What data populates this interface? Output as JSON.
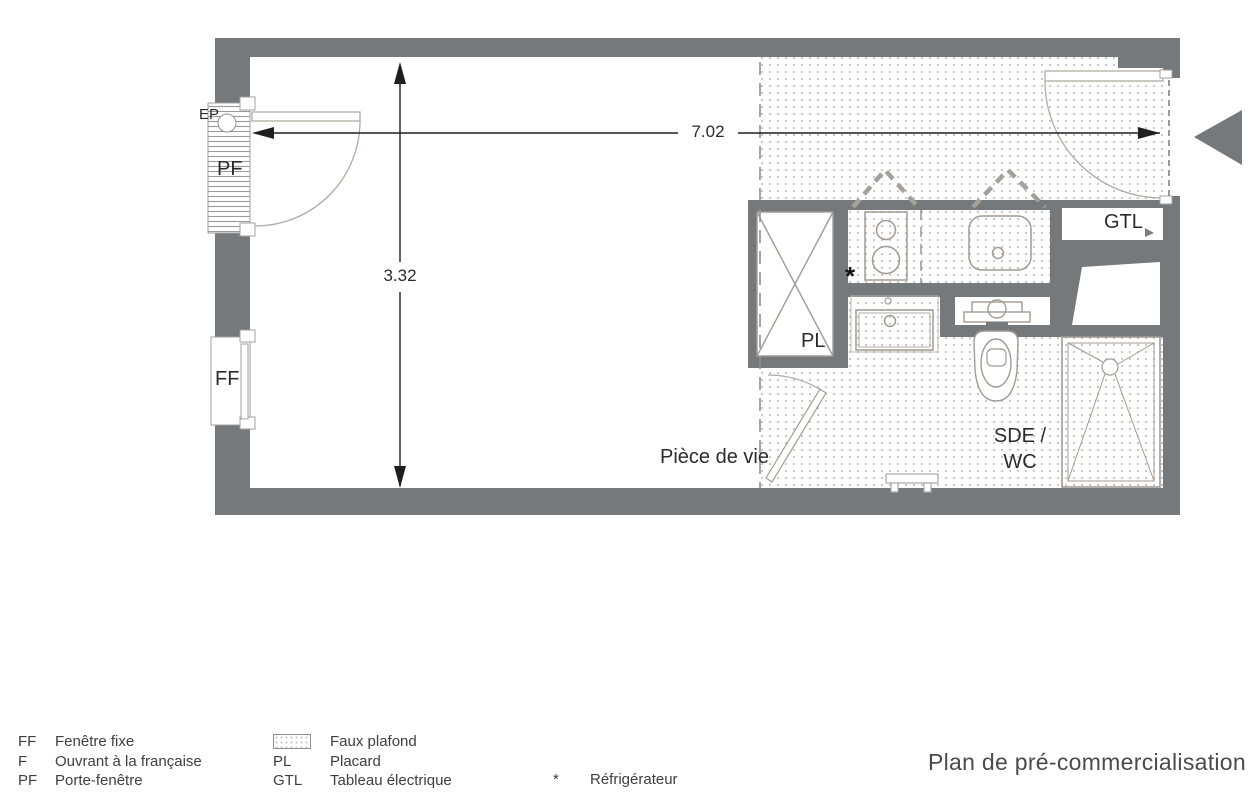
{
  "title": "Plan de pré-commercialisation",
  "plan": {
    "dim_width": "7.02",
    "dim_height": "3.32",
    "living_room": "Pièce de vie",
    "bathroom_l1": "SDE /",
    "bathroom_l2": "WC",
    "label_ep": "EP",
    "label_pf": "PF",
    "label_ff": "FF",
    "label_pl": "PL",
    "label_gtl": "GTL",
    "fridge_marker": "*"
  },
  "legend": {
    "col1": [
      {
        "key": "FF",
        "label": "Fenêtre fixe"
      },
      {
        "key": "F",
        "label": "Ouvrant à la française"
      },
      {
        "key": "PF",
        "label": "Porte-fenêtre"
      }
    ],
    "col2_swatch_label": "Faux plafond",
    "col2": [
      {
        "key": "PL",
        "label": "Placard"
      },
      {
        "key": "GTL",
        "label": "Tableau électrique"
      }
    ],
    "col3": [
      {
        "key": "*",
        "label": "Réfrigérateur"
      }
    ]
  },
  "colors": {
    "wall_gray": "#76797b",
    "fixture_line": "#a29a93",
    "dimension_line": "#1f1f1f",
    "faux_plafond_dot": "#c2c2c2"
  }
}
